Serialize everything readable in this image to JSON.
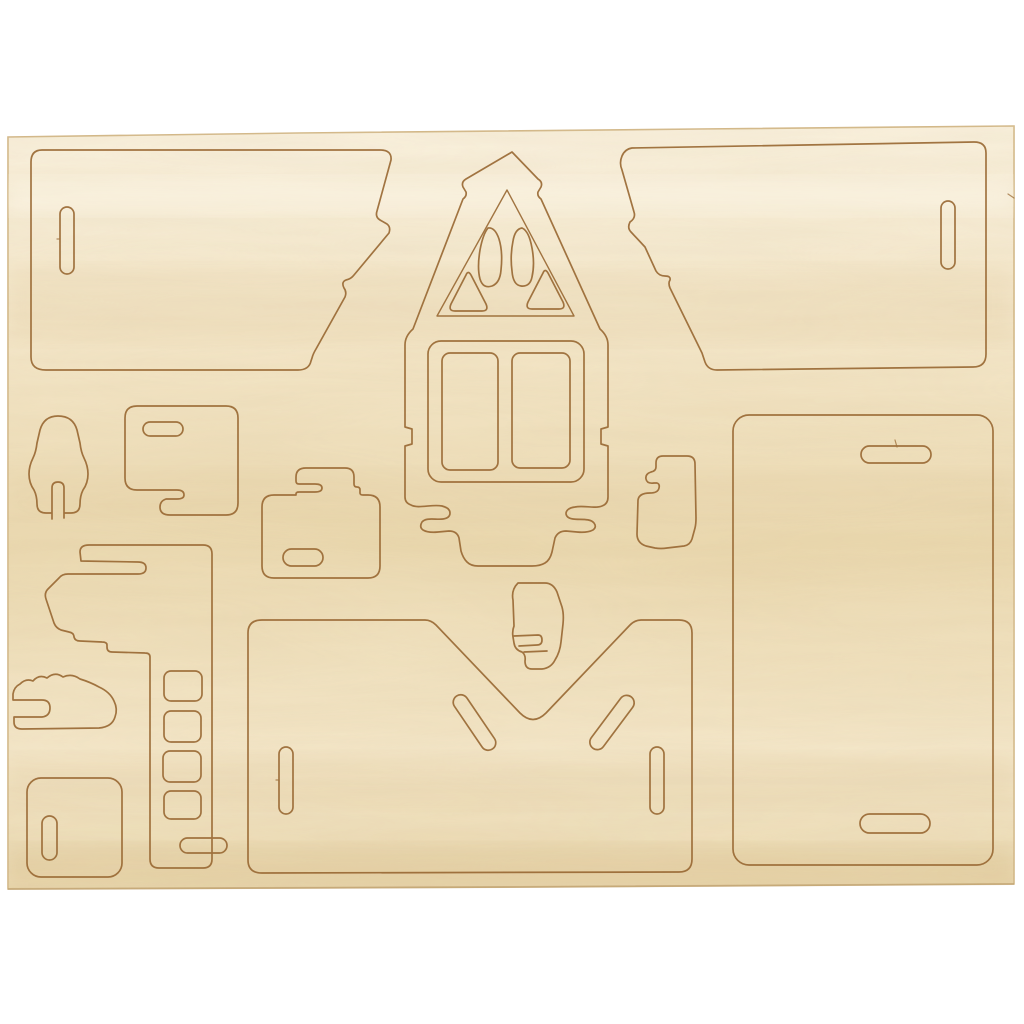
{
  "scene": {
    "type": "product-photo",
    "subject": "Laser-cut plywood 3D house puzzle kit sheet",
    "description": "Light birch plywood press-out sheet on a white background, laser-cut with pieces for assembling a miniature house: two zigzag-edged roof panels, a gabled house front with triangular attic windows and a double casement window, a large side panel, a base panel with a V-shaped notch, a chimney ladder strip and assorted small jointing pieces.",
    "background_color": "#ffffff",
    "sheet": {
      "fill_light": "#f9f0dc",
      "fill_base": "#f3e5c6",
      "fill_shade": "#e9d6ab",
      "edge_color": "#d2b787",
      "cut_line_color": "#9a6a35",
      "left": 8,
      "top": 126,
      "right": 1014,
      "bottom": 889
    },
    "pieces": [
      {
        "id": "roof-panel-left",
        "label": "Roof panel (left) with finger-joint zigzag edge and one vertical slot",
        "bbox": [
          30,
          150,
          362,
          220
        ]
      },
      {
        "id": "roof-panel-right",
        "label": "Roof panel (right), mirrored, with one vertical slot",
        "bbox": [
          619,
          142,
          367,
          227
        ]
      },
      {
        "id": "house-front",
        "label": "House front wall with pointed gable, engraved inner gable line, two arched attic window cutouts, two triangular window cutouts, double casement window frame and puzzle-hook feet",
        "bbox": [
          405,
          152,
          203,
          415
        ]
      },
      {
        "id": "side-panel-large",
        "label": "Large rounded side/back panel with two horizontal tab slots",
        "bbox": [
          733,
          415,
          260,
          450
        ]
      },
      {
        "id": "base-panel-v",
        "label": "Base panel with V-shaped roof notch, two diagonal slots and two vertical slots",
        "bbox": [
          248,
          620,
          444,
          253
        ]
      },
      {
        "id": "corner-piece",
        "label": "Small corner piece with zigzag finger cut, nested above the V notch",
        "bbox": [
          510,
          583,
          53,
          86
        ]
      },
      {
        "id": "hook-bracket",
        "label": "Small hook bracket piece right of the house front",
        "bbox": [
          637,
          455,
          59,
          93
        ]
      },
      {
        "id": "suitcase-piece",
        "label": "Small plate with top tab, open finger slot and horizontal slot",
        "bbox": [
          262,
          468,
          118,
          110
        ]
      },
      {
        "id": "slotted-plate",
        "label": "Square plate with horizontal slot and bottom hook tab",
        "bbox": [
          125,
          406,
          113,
          109
        ]
      },
      {
        "id": "arch-pawn",
        "label": "Arched pawn-shaped piece with bottom notch",
        "bbox": [
          29,
          416,
          59,
          97
        ]
      },
      {
        "id": "chimney-strip",
        "label": "Long chimney/ladder strip with four square holes, open finger slot and bottom slot",
        "bbox": [
          44,
          545,
          168,
          323
        ]
      },
      {
        "id": "cleat-piece",
        "label": "Small wavy cleat with open side slot",
        "bbox": [
          13,
          671,
          104,
          58
        ]
      },
      {
        "id": "slot-square",
        "label": "Small square plate with vertical slot",
        "bbox": [
          27,
          778,
          95,
          99
        ]
      }
    ]
  }
}
